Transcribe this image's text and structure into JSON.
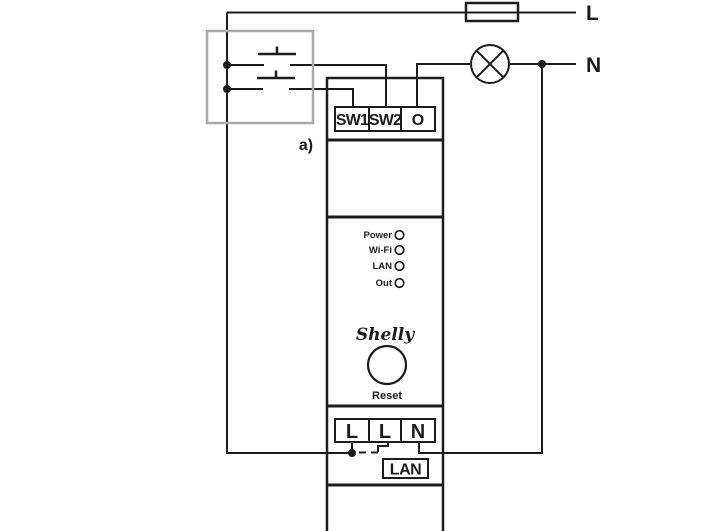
{
  "labels": {
    "live": "L",
    "neutral": "N",
    "variant": "a)"
  },
  "device": {
    "top_terminals": [
      "SW1",
      "SW2",
      "O"
    ],
    "leds": [
      "Power",
      "Wi-Fi",
      "LAN",
      "Out"
    ],
    "brand": "Shelly",
    "reset": "Reset",
    "bottom_terminals": [
      "L",
      "L",
      "N"
    ],
    "lan": "LAN"
  },
  "colors": {
    "line": "#1c1c1c",
    "switch_box": "#a9a9a9",
    "background": "#ffffff"
  }
}
